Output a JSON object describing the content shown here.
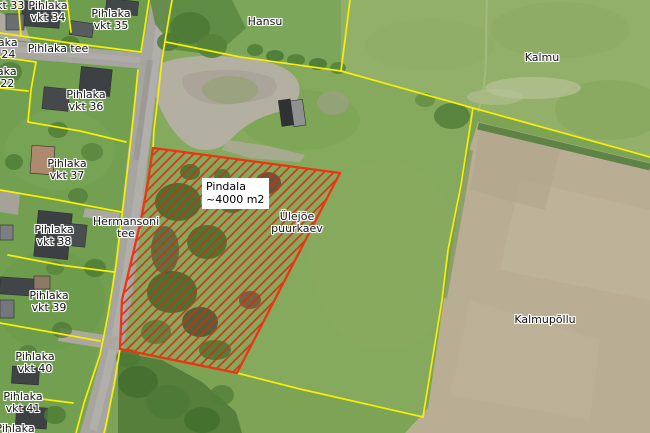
{
  "map": {
    "labels": {
      "vkt33": {
        "l1": "Pihlaka",
        "l2": "vkt 33"
      },
      "vkt34": {
        "l1": "Pihlaka",
        "l2": "vkt 34"
      },
      "vkt35": {
        "l1": "Pihlaka",
        "l2": "vkt 35"
      },
      "vkt24": {
        "l1": "Pihlaka",
        "l2": "vkt 24"
      },
      "vkt22": {
        "l1": "Pihlaka",
        "l2": "vkt 22"
      },
      "vkt36": {
        "l1": "Pihlaka",
        "l2": "vkt 36"
      },
      "vkt37": {
        "l1": "Pihlaka",
        "l2": "vkt 37"
      },
      "vkt38": {
        "l1": "Pihlaka",
        "l2": "vkt 38"
      },
      "vkt39": {
        "l1": "Pihlaka",
        "l2": "vkt 39"
      },
      "vkt40": {
        "l1": "Pihlaka",
        "l2": "vkt 40"
      },
      "vkt41": {
        "l1": "Pihlaka",
        "l2": "vkt 41"
      },
      "pihlaka_partial": {
        "l1": "Pihlaka",
        "l2": "vkt 42"
      },
      "pihlaka_tee": {
        "l1": "Pihlaka tee"
      },
      "hermansoni_tee": {
        "l1": "Hermansoni",
        "l2": "tee"
      },
      "hansu": {
        "l1": "Hansu"
      },
      "kalmu": {
        "l1": "Kalmu"
      },
      "kalmupollu": {
        "l1": "Kalmupõllu"
      },
      "ulejoe": {
        "l1": "Ülejõe",
        "l2": "puurkaev"
      }
    },
    "measurement": {
      "line1": "Pindala",
      "line2": "~4000 m2"
    },
    "colors": {
      "cadastral_boundary": "#f7ef05",
      "selection_outline": "#ee3512",
      "selection_hatch": "#d92b10",
      "grass_field": "#84a85c",
      "plowed_field": "#b9ae93",
      "road": "#a7a5a0",
      "label_text": "#111111",
      "measure_box_bg": "#ffffff"
    }
  }
}
